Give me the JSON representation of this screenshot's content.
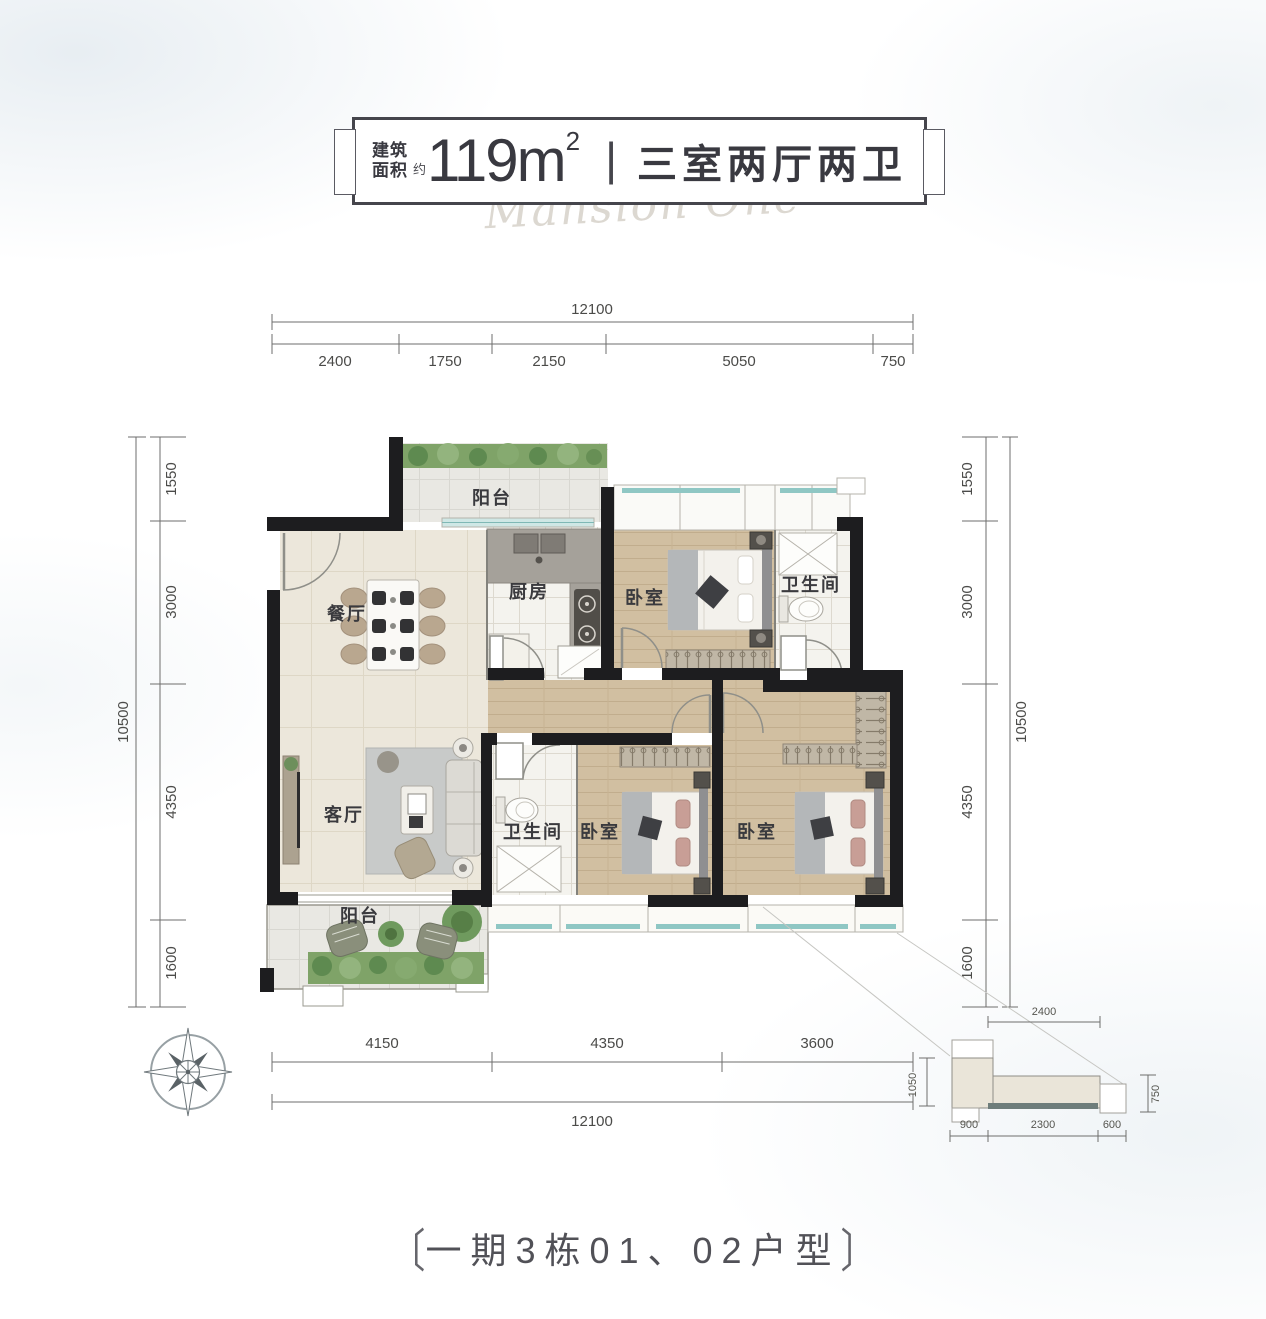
{
  "header": {
    "area_label_l1": "建筑",
    "area_label_l2": "面积",
    "approx": "约",
    "area_value": "119m",
    "area_exp": "2",
    "separator": "|",
    "spec": "三室两厅两卫",
    "watermark": "Mansion One"
  },
  "rooms": {
    "balcony_top": "阳台",
    "dining": "餐厅",
    "kitchen": "厨房",
    "bedroom_top": "卧室",
    "bath_top": "卫生间",
    "living": "客厅",
    "bath_mid": "卫生间",
    "bedroom_mid": "卧室",
    "bedroom_right": "卧室",
    "balcony_bottom": "阳台"
  },
  "dims": {
    "top": {
      "total": "12100",
      "segments": [
        "2400",
        "1750",
        "2150",
        "5050",
        "750"
      ]
    },
    "left": {
      "total": "10500",
      "segments": [
        "1550",
        "3000",
        "4350",
        "1600"
      ]
    },
    "right": {
      "total": "10500",
      "segments": [
        "1550",
        "3000",
        "4350",
        "1600"
      ]
    },
    "bottom": {
      "segments": [
        "4150",
        "4350",
        "3600"
      ],
      "total": "12100",
      "step": "1050"
    },
    "detail": {
      "top": "2400",
      "right": "750",
      "bottom": [
        "900",
        "2300",
        "600"
      ]
    }
  },
  "footer": {
    "bracket_left": "〔",
    "caption": "一期3栋01、02户型",
    "bracket_right": "〕"
  },
  "colors": {
    "wall": "#1d1d1f",
    "window_glass": "#8fc7c4",
    "wood_floor": "#d1bfa1",
    "cream_floor": "#ece7db",
    "tile_floor": "#f4f3ee",
    "plant_green": "#7fa368",
    "dimension_line": "#6e6e6c"
  }
}
